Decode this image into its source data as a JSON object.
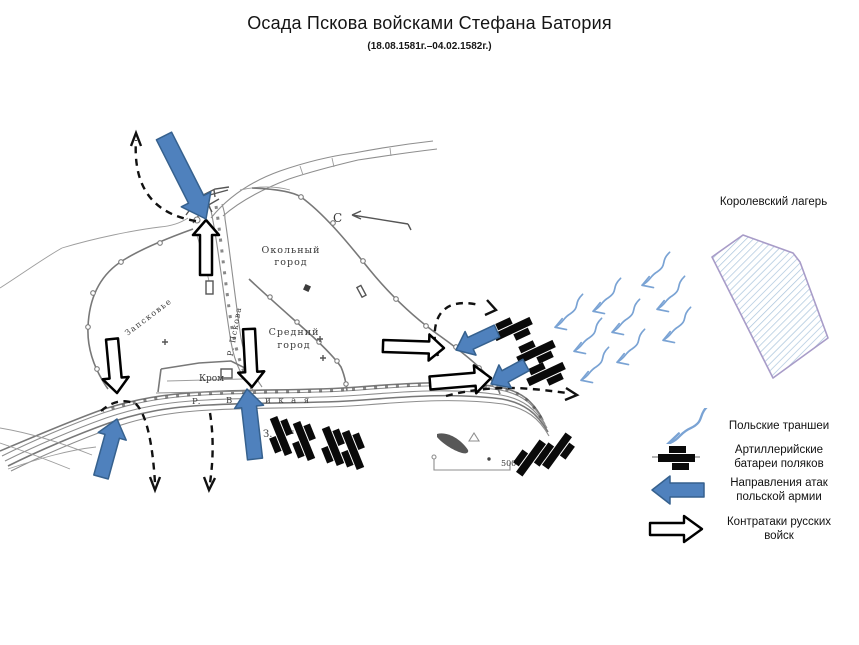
{
  "title": "Осада Пскова войсками Стефана Батория",
  "subtitle": "(18.08.1581г.–04.02.1582г.)",
  "camp": {
    "label": "Королевский лагерь"
  },
  "legend": {
    "items": [
      {
        "id": "polish-trenches",
        "label": "Польские траншеи"
      },
      {
        "id": "artillery-batteries",
        "label": "Артиллерийские батареи поляков"
      },
      {
        "id": "polish-attacks",
        "label": "Направления атак польской армии"
      },
      {
        "id": "russian-counterattacks",
        "label": "Контратаки русских войск"
      }
    ]
  },
  "map_labels": {
    "north": "С",
    "okolny": [
      "Окольный",
      "город"
    ],
    "sredny": [
      "Средний",
      "город"
    ],
    "zapskovye": "Запсковье",
    "krom": "Кром",
    "pskova": "Р. Пскова",
    "velikaya_r": "Р.",
    "velikaya": "Великая",
    "zavelichye": "З.",
    "zavelichye_small": "ал",
    "scale_value": "500"
  },
  "colors": {
    "polish_blue": "#4f81bd",
    "polish_blue_border": "#36618e",
    "trench_blue": "#7aa3d4",
    "dashed_black": "#111111",
    "battery_black": "#0a0a0a",
    "camp_border": "#a89cc8",
    "camp_hatch": "#a9c4dc"
  },
  "map_data": {
    "polish_attack_arrows": [
      {
        "from": [
          164,
          136
        ],
        "to": [
          206,
          219
        ],
        "shaft": 17,
        "head": 33,
        "head_len": 22
      },
      {
        "from": [
          497,
          331
        ],
        "to": [
          456,
          350
        ],
        "shaft": 13,
        "head": 26,
        "head_len": 16
      },
      {
        "from": [
          526,
          365
        ],
        "to": [
          491,
          384
        ],
        "shaft": 13,
        "head": 26,
        "head_len": 16
      },
      {
        "from": [
          101,
          477
        ],
        "to": [
          117,
          419
        ],
        "shaft": 15,
        "head": 29,
        "head_len": 18
      },
      {
        "from": [
          255,
          459
        ],
        "to": [
          247,
          389
        ],
        "shaft": 15,
        "head": 29,
        "head_len": 18
      }
    ],
    "russian_counterattack_arrows": [
      {
        "from": [
          206,
          275
        ],
        "to": [
          206,
          220
        ],
        "shaft": 12,
        "head": 26,
        "head_len": 15
      },
      {
        "from": [
          112,
          339
        ],
        "to": [
          117,
          393
        ],
        "shaft": 12,
        "head": 26,
        "head_len": 15
      },
      {
        "from": [
          249,
          329
        ],
        "to": [
          252,
          387
        ],
        "shaft": 12,
        "head": 26,
        "head_len": 15
      },
      {
        "from": [
          383,
          346
        ],
        "to": [
          444,
          348
        ],
        "shaft": 12,
        "head": 26,
        "head_len": 15
      },
      {
        "from": [
          430,
          383
        ],
        "to": [
          491,
          378
        ],
        "shaft": 13,
        "head": 28,
        "head_len": 16
      }
    ],
    "batteries": [
      {
        "x": 513,
        "y": 329,
        "angle": -25
      },
      {
        "x": 536,
        "y": 352,
        "angle": -25
      },
      {
        "x": 546,
        "y": 374,
        "angle": -25
      },
      {
        "x": 281,
        "y": 436,
        "angle": 68
      },
      {
        "x": 304,
        "y": 441,
        "angle": 68
      },
      {
        "x": 333,
        "y": 446,
        "angle": 68
      },
      {
        "x": 353,
        "y": 450,
        "angle": 68
      },
      {
        "x": 531,
        "y": 458,
        "angle": -54
      },
      {
        "x": 557,
        "y": 451,
        "angle": -54
      }
    ],
    "trench_arrows": [
      {
        "x": 645,
        "y": 271,
        "angle": -15
      },
      {
        "x": 596,
        "y": 297,
        "angle": -15
      },
      {
        "x": 558,
        "y": 313,
        "angle": -15
      },
      {
        "x": 660,
        "y": 295,
        "angle": -15
      },
      {
        "x": 615,
        "y": 318,
        "angle": -15
      },
      {
        "x": 577,
        "y": 337,
        "angle": -15
      },
      {
        "x": 666,
        "y": 326,
        "angle": -15
      },
      {
        "x": 620,
        "y": 348,
        "angle": -15
      },
      {
        "x": 584,
        "y": 366,
        "angle": -15
      }
    ],
    "dashed_routes": [
      {
        "d": "M 196,221 C 152,214 133,186 136,140",
        "head": [
          [
            131,
            146
          ],
          [
            136,
            133
          ],
          [
            141,
            146
          ]
        ]
      },
      {
        "d": "M 101,411 Q 118,396 136,404 C 148,416 153,450 155,483",
        "head": [
          [
            150,
            477
          ],
          [
            155,
            490
          ],
          [
            160,
            477
          ]
        ]
      },
      {
        "d": "M 210,413 C 214,438 213,462 210,483",
        "head": [
          [
            204,
            477
          ],
          [
            209,
            490
          ],
          [
            215,
            478
          ]
        ]
      },
      {
        "d": "M 438,356 C 432,337 434,317 445,309 C 453,302 467,302 479,305",
        "head": [
          [
            487,
            300
          ],
          [
            496,
            310
          ],
          [
            485,
            315
          ]
        ]
      },
      {
        "d": "M 446,396 C 468,390 500,386 531,389 C 546,390 558,392 567,393",
        "head": [
          [
            566,
            388
          ],
          [
            577,
            395
          ],
          [
            565,
            400
          ]
        ]
      }
    ]
  }
}
